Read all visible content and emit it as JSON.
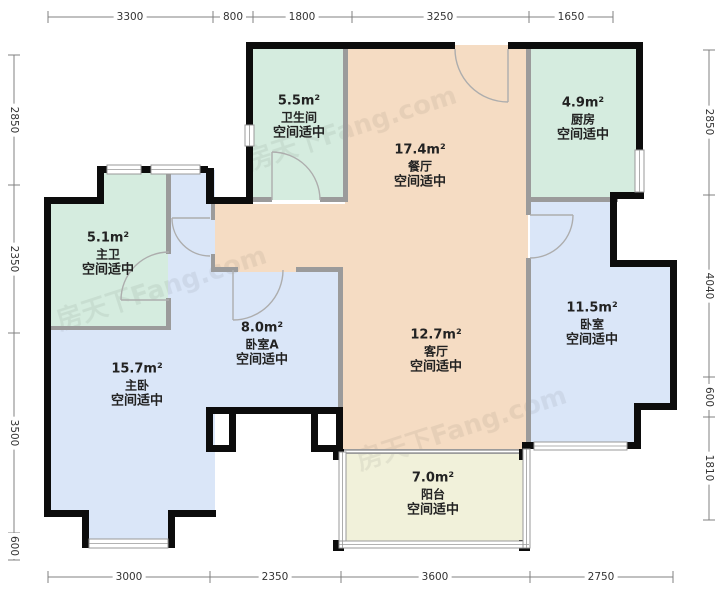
{
  "watermark": {
    "text": "房天下Fang.com"
  },
  "rooms": [
    {
      "id": "bathroom",
      "area": "5.5m²",
      "name": "卫生间",
      "note": "空间适中"
    },
    {
      "id": "dining",
      "area": "17.4m²",
      "name": "餐厅",
      "note": "空间适中"
    },
    {
      "id": "kitchen",
      "area": "4.9m²",
      "name": "厨房",
      "note": "空间适中"
    },
    {
      "id": "master-bath",
      "area": "5.1m²",
      "name": "主卫",
      "note": "空间适中"
    },
    {
      "id": "master-bedroom",
      "area": "15.7m²",
      "name": "主卧",
      "note": "空间适中"
    },
    {
      "id": "bedroom-a",
      "area": "8.0m²",
      "name": "卧室A",
      "note": "空间适中"
    },
    {
      "id": "living",
      "area": "12.7m²",
      "name": "客厅",
      "note": "空间适中"
    },
    {
      "id": "bedroom",
      "area": "11.5m²",
      "name": "卧室",
      "note": "空间适中"
    },
    {
      "id": "balcony",
      "area": "7.0m²",
      "name": "阳台",
      "note": "空间适中"
    }
  ],
  "dimensions": {
    "top": [
      "3300",
      "800",
      "1800",
      "3250",
      "1650"
    ],
    "bottom": [
      "3000",
      "2350",
      "3600",
      "2750"
    ],
    "left": [
      "2850",
      "2350",
      "3500",
      "600"
    ],
    "right": [
      "2850",
      "4040",
      "600",
      "1810"
    ]
  },
  "colors": {
    "bath_kitchen": "#d5ecdf",
    "bedroom": "#dae6f8",
    "living_dining": "#f5dcc3",
    "balcony": "#f1f1da",
    "wall": "#0c0c0c",
    "inner_wall": "#9b9b9b"
  }
}
